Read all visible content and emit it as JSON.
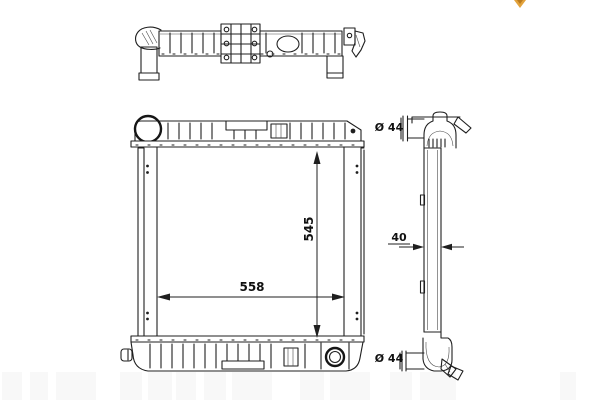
{
  "drawing": {
    "type": "radiator-technical-drawing",
    "background": "#ffffff",
    "line_color": "#1f1f1f",
    "watermark_color": "#e2a23b",
    "dimensions": {
      "core_height": {
        "label": "545"
      },
      "core_width": {
        "label": "558"
      },
      "core_depth": {
        "label": "40"
      },
      "top_pipe_diameter": {
        "label": "Ø 44"
      },
      "bottom_pipe_diameter": {
        "label": "Ø 44"
      }
    }
  }
}
